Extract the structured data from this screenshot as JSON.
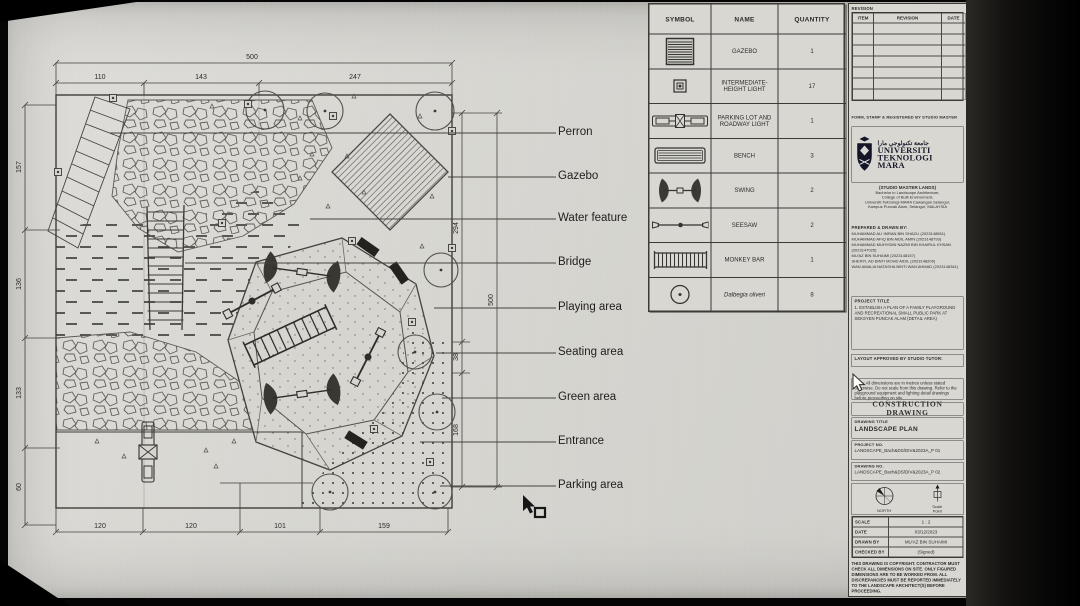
{
  "plan": {
    "labels": [
      "Perron",
      "Gazebo",
      "Water feature",
      "Bridge",
      "Playing area",
      "Seating area",
      "Green area",
      "Entrance",
      "Parking area"
    ],
    "dimensions": {
      "top_total": "500",
      "top": [
        "110",
        "143",
        "247"
      ],
      "left": [
        "157",
        "136",
        "133",
        "60"
      ],
      "right": [
        "294",
        "38",
        "168"
      ],
      "right_total": "500",
      "bottom": [
        "120",
        "120",
        "101",
        "159"
      ]
    }
  },
  "legend": {
    "headers": [
      "SYMBOL",
      "NAME",
      "QUANTITY"
    ],
    "rows": [
      {
        "name": "GAZEBO",
        "quantity": "1"
      },
      {
        "name": "INTERMEDIATE-HEIGHT LIGHT",
        "quantity": "17"
      },
      {
        "name": "PARKING LOT AND ROADWAY LIGHT",
        "quantity": "1"
      },
      {
        "name": "BENCH",
        "quantity": "3"
      },
      {
        "name": "SWING",
        "quantity": "2"
      },
      {
        "name": "SEESAW",
        "quantity": "2"
      },
      {
        "name": "MONKEY BAR",
        "quantity": "1"
      },
      {
        "name": "Dalbegia oliveri",
        "quantity": "8"
      }
    ]
  },
  "title_block": {
    "revision_label": "REVISION",
    "revision_headers": [
      "ITEM",
      "REVISION",
      "DATE"
    ],
    "registration_note": "FORM, STAMP & REGISTERED BY STUDIO MASTER",
    "university": {
      "arabic": "جامعة تكنولوجي مارا",
      "name_line1": "UNIVERSITI",
      "name_line2": "TEKNOLOGI",
      "name_line3": "MARA",
      "studio": "(STUDIO MASTER LANDS)",
      "address1": "Bachelor in Landscape Architecture,",
      "address2": "College of Built Environment,",
      "address3": "Universiti Teknologi MARA Cawangan Selangor,",
      "address4": "Kampus Puncak Alam, Selangor, MALAYSIA"
    },
    "prepared_label": "PREPARED & DRAWN BY:",
    "prepared_names": [
      "MUHAMMAD ALI IMRAN BIN SHAZLI (2023148561)",
      "MUHAMMAD AFIQ BIN AIDIL AMIN (2023148793)",
      "MUHAMMAD MUHYIDIN NAZMI BIN KHAIRUL EHSAN (2023147025)",
      "MU'AZ BIN SUHAIMI (2023148157)",
      "SHERYL AD BINTI MOHD AIDIL (2023148209)",
      "WAN AMALIA NATASHA BINTI WAN AHMAD (2023148341)"
    ],
    "project_title_label": "PROJECT TITLE",
    "project_title_text": "1.  ESTABLISH A PLAN OF A FAMILY PLAYGROUND AND RECREATIONAL SMALL PUBLIC PARK AT SEKSYEN PUNCAK ALAM (DETAIL AREA)",
    "approval_label": "LAYOUT APPROVED BY STUDIO TUTOR:",
    "note_text": "Note: All dimensions are in metres unless stated otherwise. Do not scale from this drawing. Refer to the playground equipment and lighting detail drawings before proceeding on site.",
    "drawing_type": "CONSTRUCTION DRAWING",
    "drawing_title_label": "DRAWING TITLE",
    "drawing_title_value": "LANDSCAPE PLAN",
    "project_no_label": "PROJECT NO.",
    "project_no_value": "LANDSCAPE_Bach&DS/DIV&2023A_P 01",
    "drawing_no_label": "DRAWING NO.",
    "drawing_no_value": "LANDSCAPE_Bach&DS/DIV&2023A_P 02",
    "north_label": "NORTH",
    "scale_label": "Scale",
    "scale_sub": "Point",
    "info_rows": [
      {
        "label": "SCALE",
        "value": "1 : 2"
      },
      {
        "label": "DATE",
        "value": "03/12/2023"
      },
      {
        "label": "DRAWN BY",
        "value": "MU'AZ BIN SUHAIMI"
      },
      {
        "label": "CHECKED BY",
        "value": "(Signed)"
      }
    ],
    "copyright": "THIS DRAWING IS COPYRIGHT. CONTRACTOR MUST CHECK ALL DIMENSIONS ON SITE. ONLY FIGURED DIMENSIONS ARE TO BE WORKED FROM. ALL DISCREPANCIES MUST BE REPORTED IMMEDIATELY TO THE LANDSCAPE ARCHITECT(S) BEFORE PROCEEDING."
  }
}
